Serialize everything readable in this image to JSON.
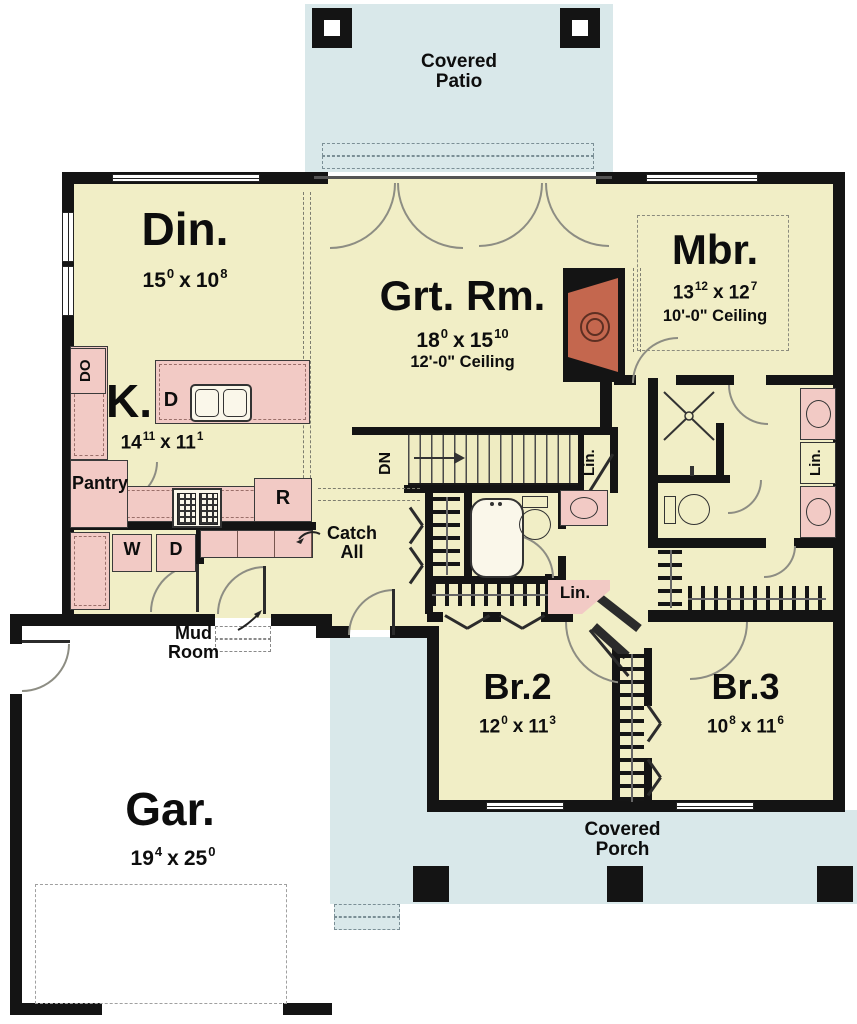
{
  "outdoor": {
    "patio": {
      "line1": "Covered",
      "line2": "Patio"
    },
    "porch": {
      "line1": "Covered",
      "line2": "Porch"
    }
  },
  "rooms": {
    "din": {
      "name": "Din.",
      "dim": {
        "a": "15",
        "asup": "0",
        "b": "10",
        "bsup": "8"
      }
    },
    "grt": {
      "name": "Grt. Rm.",
      "dim": {
        "a": "18",
        "asup": "0",
        "b": "15",
        "bsup": "10"
      },
      "ceiling": "12'-0\" Ceiling"
    },
    "mbr": {
      "name": "Mbr.",
      "dim": {
        "a": "13",
        "asup": "12",
        "b": "12",
        "bsup": "7"
      },
      "ceiling": "10'-0\" Ceiling"
    },
    "kitchen": {
      "name": "K.",
      "dim": {
        "a": "14",
        "asup": "11",
        "b": "11",
        "bsup": "1"
      }
    },
    "garage": {
      "name": "Gar.",
      "dim": {
        "a": "19",
        "asup": "4",
        "b": "25",
        "bsup": "0"
      }
    },
    "br2": {
      "name": "Br.2",
      "dim": {
        "a": "12",
        "asup": "0",
        "b": "11",
        "bsup": "3"
      }
    },
    "br3": {
      "name": "Br.3",
      "dim": {
        "a": "10",
        "asup": "8",
        "b": "11",
        "bsup": "6"
      }
    }
  },
  "labels": {
    "dim_sep": "x",
    "pantry": "Pantry",
    "catch_all_1": "Catch",
    "catch_all_2": "All",
    "mud_1": "Mud",
    "mud_2": "Room",
    "stairs_dir": "DN",
    "linen": "Lin.",
    "washer": "W",
    "dryer": "D",
    "dishwasher": "D",
    "double_oven": "DO",
    "refrigerator": "R"
  },
  "colors": {
    "room_fill": "#f1eec6",
    "cabinet_fill": "#f2cac5",
    "outdoor_fill": "#d9e8ea",
    "wall": "#141414",
    "fireplace": "#c4674e"
  }
}
